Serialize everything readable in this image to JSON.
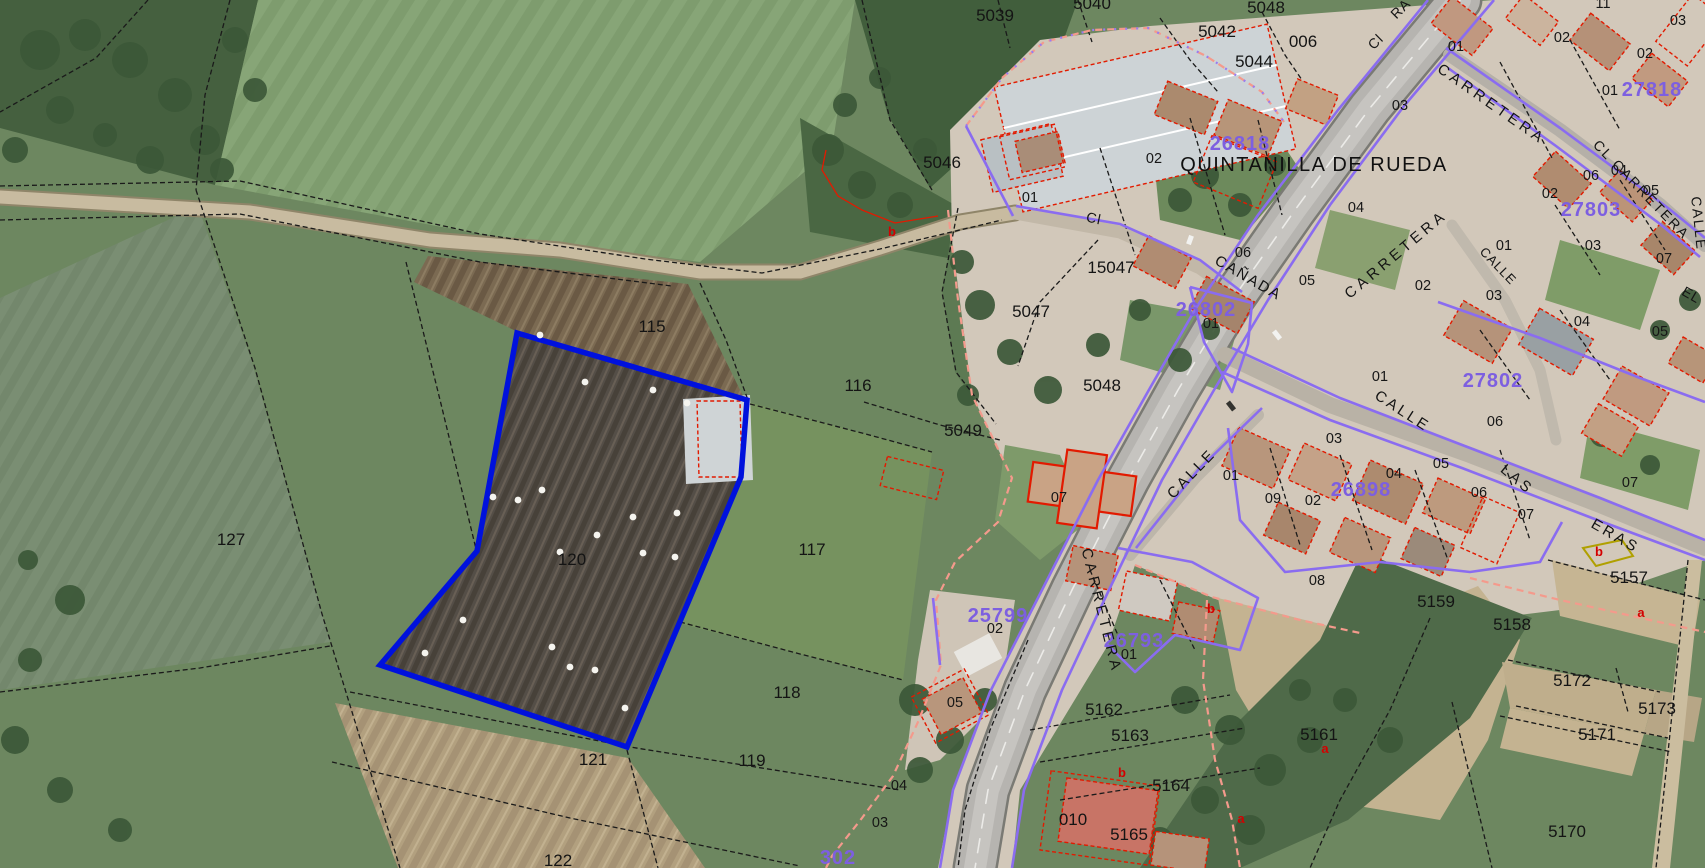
{
  "map": {
    "place": {
      "t": "QUINTANILLA DE RUEDA",
      "x": 1314,
      "y": 171,
      "s": 20,
      "ls": 1.5
    },
    "selected_parcel_number": "120",
    "colors": {
      "selection_blue": "#0011dd",
      "block_number_purple": "#7d5fe0",
      "building_outline_red": "#e21a00",
      "boundary_pink": "#f49a8c",
      "boundary_purple": "#8a6cf0",
      "label_black": "#141414",
      "letter_red": "#d40000",
      "yellow_outline": "#b0a000"
    },
    "parcel_labels": [
      {
        "t": "5039",
        "x": 995,
        "y": 21
      },
      {
        "t": "5040",
        "x": 1092,
        "y": 9
      },
      {
        "t": "5048",
        "x": 1266,
        "y": 13
      },
      {
        "t": "5042",
        "x": 1217,
        "y": 37
      },
      {
        "t": "5044",
        "x": 1254,
        "y": 67
      },
      {
        "t": "006",
        "x": 1303,
        "y": 47
      },
      {
        "t": "5046",
        "x": 942,
        "y": 168
      },
      {
        "t": "15047",
        "x": 1111,
        "y": 273
      },
      {
        "t": "5047",
        "x": 1031,
        "y": 317
      },
      {
        "t": "5048",
        "x": 1102,
        "y": 391
      },
      {
        "t": "5049",
        "x": 963,
        "y": 436
      },
      {
        "t": "115",
        "x": 652,
        "y": 332
      },
      {
        "t": "116",
        "x": 858,
        "y": 391
      },
      {
        "t": "117",
        "x": 812,
        "y": 555
      },
      {
        "t": "118",
        "x": 787,
        "y": 698
      },
      {
        "t": "119",
        "x": 752,
        "y": 766
      },
      {
        "t": "120",
        "x": 572,
        "y": 565
      },
      {
        "t": "121",
        "x": 593,
        "y": 765
      },
      {
        "t": "122",
        "x": 558,
        "y": 866
      },
      {
        "t": "127",
        "x": 231,
        "y": 545
      },
      {
        "t": "5157",
        "x": 1629,
        "y": 583
      },
      {
        "t": "5158",
        "x": 1512,
        "y": 630
      },
      {
        "t": "5159",
        "x": 1436,
        "y": 607
      },
      {
        "t": "5161",
        "x": 1319,
        "y": 740
      },
      {
        "t": "5162",
        "x": 1104,
        "y": 715
      },
      {
        "t": "5163",
        "x": 1130,
        "y": 741
      },
      {
        "t": "5164",
        "x": 1171,
        "y": 791
      },
      {
        "t": "5165",
        "x": 1129,
        "y": 840
      },
      {
        "t": "5170",
        "x": 1567,
        "y": 837
      },
      {
        "t": "5171",
        "x": 1597,
        "y": 740
      },
      {
        "t": "5172",
        "x": 1572,
        "y": 686
      },
      {
        "t": "5173",
        "x": 1657,
        "y": 714
      },
      {
        "t": "010",
        "x": 1073,
        "y": 825
      }
    ],
    "unit_labels": [
      {
        "t": "01",
        "x": 1030,
        "y": 202
      },
      {
        "t": "02",
        "x": 1154,
        "y": 163
      },
      {
        "t": "06",
        "x": 1243,
        "y": 257
      },
      {
        "t": "04",
        "x": 1356,
        "y": 212
      },
      {
        "t": "01",
        "x": 1211,
        "y": 328
      },
      {
        "t": "05",
        "x": 1307,
        "y": 285
      },
      {
        "t": "02",
        "x": 1423,
        "y": 290
      },
      {
        "t": "03",
        "x": 1494,
        "y": 300
      },
      {
        "t": "04",
        "x": 1582,
        "y": 326
      },
      {
        "t": "05",
        "x": 1660,
        "y": 336
      },
      {
        "t": "01",
        "x": 1456,
        "y": 51
      },
      {
        "t": "02",
        "x": 1562,
        "y": 42
      },
      {
        "t": "11",
        "x": 1603,
        "y": 8
      },
      {
        "t": "03",
        "x": 1678,
        "y": 25
      },
      {
        "t": "02",
        "x": 1645,
        "y": 58
      },
      {
        "t": "01",
        "x": 1610,
        "y": 95
      },
      {
        "t": "03",
        "x": 1400,
        "y": 110
      },
      {
        "t": "02",
        "x": 1550,
        "y": 198
      },
      {
        "t": "06",
        "x": 1591,
        "y": 180
      },
      {
        "t": "04",
        "x": 1619,
        "y": 175
      },
      {
        "t": "05",
        "x": 1651,
        "y": 195
      },
      {
        "t": "03",
        "x": 1593,
        "y": 250
      },
      {
        "t": "07",
        "x": 1664,
        "y": 263
      },
      {
        "t": "01",
        "x": 1504,
        "y": 250
      },
      {
        "t": "01",
        "x": 1380,
        "y": 381
      },
      {
        "t": "06",
        "x": 1495,
        "y": 426
      },
      {
        "t": "03",
        "x": 1334,
        "y": 443
      },
      {
        "t": "05",
        "x": 1441,
        "y": 468
      },
      {
        "t": "04",
        "x": 1394,
        "y": 478
      },
      {
        "t": "06",
        "x": 1479,
        "y": 497
      },
      {
        "t": "07",
        "x": 1526,
        "y": 519
      },
      {
        "t": "07",
        "x": 1630,
        "y": 487
      },
      {
        "t": "01",
        "x": 1231,
        "y": 480
      },
      {
        "t": "09",
        "x": 1273,
        "y": 503
      },
      {
        "t": "02",
        "x": 1313,
        "y": 505
      },
      {
        "t": "08",
        "x": 1317,
        "y": 585
      },
      {
        "t": "07",
        "x": 1059,
        "y": 502
      },
      {
        "t": "02",
        "x": 995,
        "y": 633
      },
      {
        "t": "01",
        "x": 1129,
        "y": 659
      },
      {
        "t": "05",
        "x": 955,
        "y": 707
      },
      {
        "t": "04",
        "x": 899,
        "y": 790
      },
      {
        "t": "03",
        "x": 880,
        "y": 827
      }
    ],
    "block_labels": [
      {
        "t": "26818",
        "x": 1240,
        "y": 150
      },
      {
        "t": "26802",
        "x": 1206,
        "y": 316
      },
      {
        "t": "27818",
        "x": 1652,
        "y": 96
      },
      {
        "t": "27803",
        "x": 1591,
        "y": 216
      },
      {
        "t": "27802",
        "x": 1493,
        "y": 387
      },
      {
        "t": "26898",
        "x": 1361,
        "y": 496
      },
      {
        "t": "26793",
        "x": 1134,
        "y": 647
      },
      {
        "t": "25799",
        "x": 998,
        "y": 622
      },
      {
        "t": "302",
        "x": 838,
        "y": 864,
        "s": 24
      }
    ],
    "street_labels": [
      {
        "t": "CARRETERA",
        "x": 1489,
        "y": 108,
        "r": 35,
        "ls": 4,
        "s": 15
      },
      {
        "t": "CARRETERA",
        "x": 1399,
        "y": 258,
        "r": -40,
        "ls": 4,
        "s": 15
      },
      {
        "t": "CARRETERA",
        "x": 1097,
        "y": 612,
        "r": 76,
        "ls": 4,
        "s": 15
      },
      {
        "t": "CL CARRETERA",
        "x": 1638,
        "y": 193,
        "r": 46,
        "ls": 2,
        "s": 14
      },
      {
        "t": "CALLE",
        "x": 1694,
        "y": 224,
        "r": 84,
        "ls": 2,
        "s": 14
      },
      {
        "t": "CALLE",
        "x": 1195,
        "y": 477,
        "r": -46,
        "ls": 3,
        "s": 15
      },
      {
        "t": "CALLE",
        "x": 1400,
        "y": 415,
        "r": 33,
        "ls": 3,
        "s": 15
      },
      {
        "t": "LAS",
        "x": 1514,
        "y": 483,
        "r": 40,
        "ls": 3,
        "s": 15
      },
      {
        "t": "ERAS",
        "x": 1613,
        "y": 540,
        "r": 30,
        "ls": 3,
        "s": 15
      },
      {
        "t": "CAÑADA",
        "x": 1246,
        "y": 282,
        "r": 30,
        "ls": 2,
        "s": 15
      },
      {
        "t": "CALLE",
        "x": 1495,
        "y": 269,
        "r": 46,
        "ls": 1,
        "s": 13
      },
      {
        "t": "Cl",
        "x": 1093,
        "y": 223,
        "r": 12,
        "ls": 1,
        "s": 14
      },
      {
        "t": "Cl",
        "x": 1379,
        "y": 45,
        "r": -45,
        "ls": 1,
        "s": 14
      },
      {
        "t": "RA",
        "x": 1404,
        "y": 12,
        "r": -45,
        "ls": 1,
        "s": 14
      },
      {
        "t": "EL",
        "x": 1689,
        "y": 299,
        "r": 30,
        "ls": 1,
        "s": 14
      }
    ],
    "letter_labels": [
      {
        "t": "b",
        "x": 892,
        "y": 236
      },
      {
        "t": "b",
        "x": 1211,
        "y": 613
      },
      {
        "t": "b",
        "x": 1122,
        "y": 777
      },
      {
        "t": "b",
        "x": 1599,
        "y": 556
      },
      {
        "t": "a",
        "x": 1641,
        "y": 617
      },
      {
        "t": "a",
        "x": 1241,
        "y": 823
      },
      {
        "t": "a",
        "x": 1325,
        "y": 753
      }
    ],
    "bale_dots": [
      [
        493,
        497
      ],
      [
        518,
        500
      ],
      [
        542,
        490
      ],
      [
        560,
        552
      ],
      [
        597,
        535
      ],
      [
        633,
        517
      ],
      [
        643,
        553
      ],
      [
        677,
        513
      ],
      [
        675,
        557
      ],
      [
        463,
        620
      ],
      [
        425,
        653
      ],
      [
        552,
        647
      ],
      [
        570,
        667
      ],
      [
        595,
        670
      ],
      [
        625,
        708
      ],
      [
        540,
        335
      ],
      [
        585,
        382
      ],
      [
        653,
        390
      ],
      [
        687,
        403
      ]
    ]
  }
}
